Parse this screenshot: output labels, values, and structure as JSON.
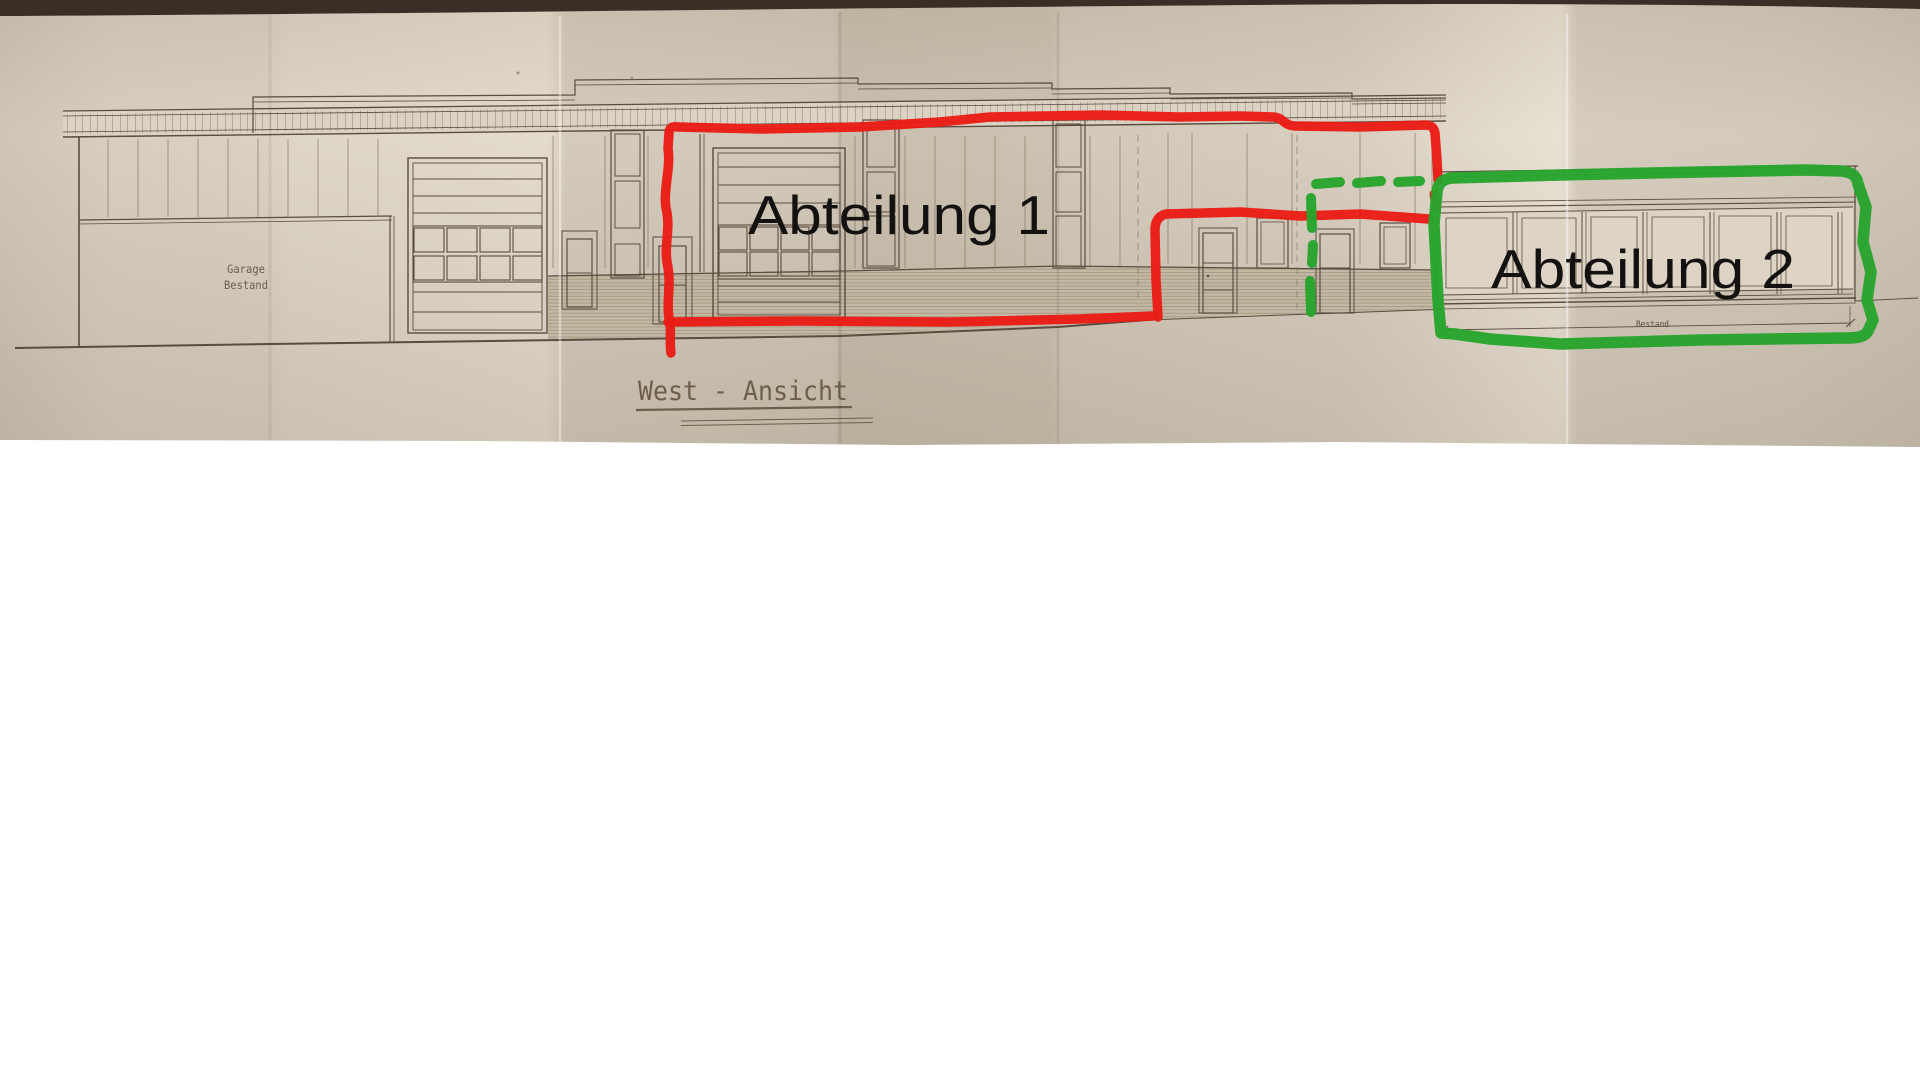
{
  "photo": {
    "annotations": {
      "department1_label": "Abteilung 1",
      "department2_label": "Abteilung 2"
    },
    "drawing": {
      "view_title": "West - Ansicht",
      "garage_label": [
        "Garage",
        "Bestand"
      ],
      "dimension_label": "Bestand"
    },
    "colors": {
      "annotation-red": "#ea1c15",
      "annotation-green": "#28a42d",
      "ink": "#5a4c3f",
      "paper": "#d5cbbc",
      "backdrop": "#392f27"
    }
  }
}
